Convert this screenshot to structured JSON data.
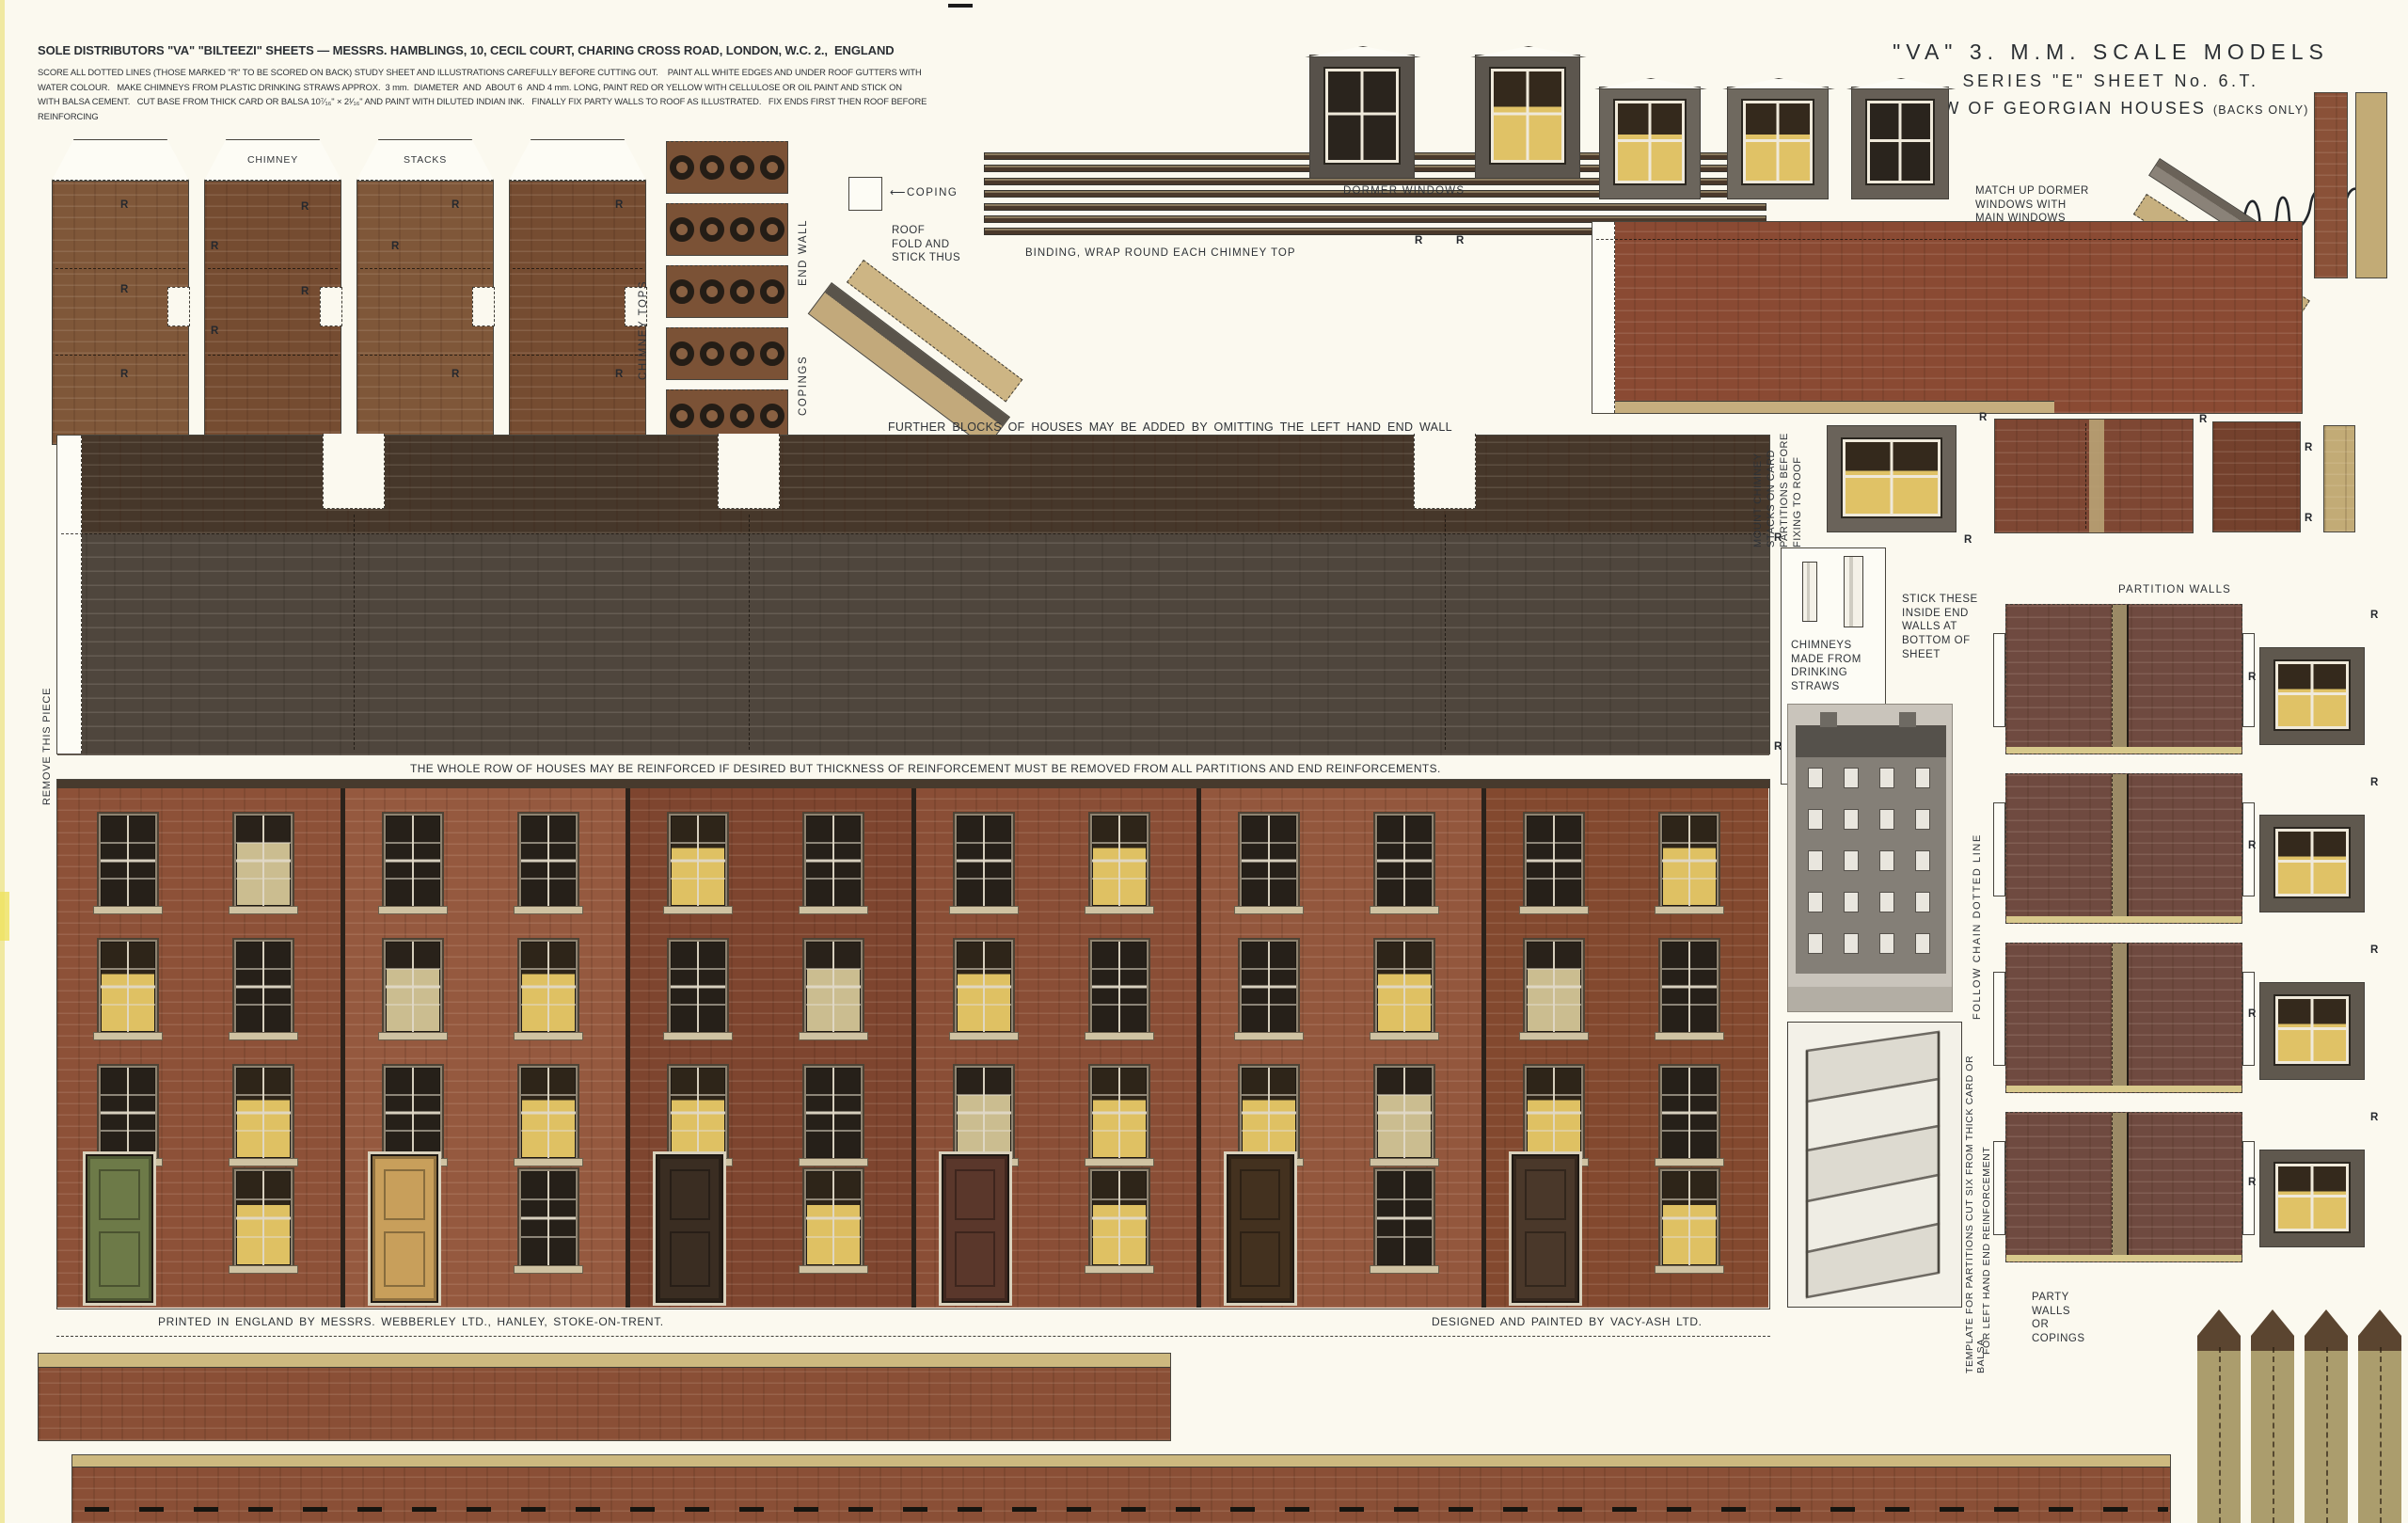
{
  "colors": {
    "paper": "#fbf9ef",
    "ink": "#2e3237",
    "brick_wall": "#8d5138",
    "roof_band": "#46372a",
    "roof_slate": "#4f463d",
    "stack_brown": "#7b5236",
    "partition_brick": "#6f4a40",
    "big_piece": "#8a4a33",
    "tan": "#c6ae7e",
    "olive": "#ab9d6d",
    "window_lit": "#dfc163",
    "sill": "#cfc2a2"
  },
  "header": {
    "title": "SOLE DISTRIBUTORS \"VA\" \"BILTEEZI\" SHEETS — MESSRS. HAMBLINGS, 10, CECIL COURT, CHARING CROSS ROAD, LONDON, W.C. 2.,  ENGLAND",
    "instructions": [
      "SCORE ALL DOTTED LINES (THOSE MARKED \"R\" TO BE SCORED ON BACK) STUDY SHEET AND ILLUSTRATIONS CAREFULLY BEFORE CUTTING OUT.    PAINT ALL WHITE EDGES AND UNDER ROOF GUTTERS WITH",
      "WATER COLOUR.   MAKE CHIMNEYS FROM PLASTIC DRINKING STRAWS APPROX.  3 mm.  DIAMETER  AND  ABOUT 6  AND 4 mm. LONG, PAINT RED OR YELLOW WITH CELLULOSE OR OIL PAINT AND STICK ON",
      "WITH BALSA CEMENT.   CUT BASE FROM THICK CARD OR BALSA 10⁷⁄₁₆\" × 2¹⁄₁₆\" AND PAINT WITH DILUTED INDIAN INK.   FINALLY FIX PARTY WALLS TO ROOF AS ILLUSTRATED.   FIX ENDS FIRST THEN ROOF BEFORE",
      "REINFORCING"
    ]
  },
  "masthead": {
    "line1": "\"VA\" 3. M.M. SCALE MODELS",
    "line2": "SERIES \"E\" SHEET No. 6.T.",
    "line3": "ROW OF GEORGIAN HOUSES",
    "line3_small": "(BACKS ONLY)"
  },
  "labels": {
    "chimney": "CHIMNEY",
    "stacks": "STACKS",
    "chimney_tops": "CHIMNEY  TOPS",
    "end_wall": "END  WALL",
    "coping": "⟵COPING",
    "roof_fold": "ROOF\nFOLD  AND\nSTICK THUS",
    "copings": "COPINGS",
    "binding": "BINDING, WRAP ROUND EACH CHIMNEY TOP",
    "dormer_windows": "DORMER  WINDOWS",
    "match_up": "MATCH UP DORMER\nWINDOWS WITH\nMAIN WINDOWS",
    "further_1": "FURTHER  BLOCKS  OF  HOUSES  MAY  BE  ADDED  BY  OMITTING  THE  LEFT  HAND  END  WALL",
    "further_2a": "AND YARD WALL.   JOIN BLOCK AND ROOF UP TO RIGHT END WALL BUT DO ",
    "further_2b": "NOT",
    "further_2c": " REMOVE SMALL PIECE FROM LEFT CORNER  OF  ROOF",
    "whole_row": "THE  WHOLE  ROW  OF  HOUSES  MAY  BE  REINFORCED  IF  DESIRED  BUT  THICKNESS  OF  REINFORCEMENT  MUST  BE  REMOVED  FROM  ALL  PARTITIONS  AND  END  REINFORCEMENTS.",
    "remove_piece": "REMOVE THIS\nPIECE",
    "mount_chimney": "MOUNT CHIMNEY STACKS ON CARD PARTITIONS BEFORE FIXING TO ROOF",
    "chimneys_straws": "CHIMNEYS\nMADE FROM\nDRINKING\nSTRAWS",
    "stick_these": "STICK THESE\nINSIDE END\nWALLS AT\nBOTTOM OF\nSHEET",
    "follow_chain": "FOLLOW CHAIN DOTTED LINE",
    "template_1": "TEMPLATE FOR PARTITIONS CUT SIX FROM THICK CARD OR BALSA",
    "template_2": "FOR LEFT HAND END REINFORCEMENT",
    "partition_walls": "PARTITION  WALLS",
    "party_walls": "PARTY\nWALLS\nOR\nCOPINGS",
    "r_mark": "R"
  },
  "captions": {
    "printer": "PRINTED  IN  ENGLAND  BY  MESSRS.  WEBBERLEY  LTD.,  HANLEY,  STOKE-ON-TRENT.",
    "designer": "DESIGNED AND PAINTED BY VACY-ASH LTD."
  },
  "houses": {
    "units": [
      {
        "shade": "#8d5138",
        "door": "#6d7a48",
        "w": [
          [
            0,
            2
          ],
          [
            1,
            0
          ],
          [
            0,
            1
          ]
        ],
        "g": 1
      },
      {
        "shade": "#95593f",
        "door": "#c89f5b",
        "w": [
          [
            0,
            0
          ],
          [
            2,
            1
          ],
          [
            0,
            1
          ]
        ],
        "g": 0
      },
      {
        "shade": "#7e452f",
        "door": "#3a2d22",
        "w": [
          [
            1,
            0
          ],
          [
            0,
            2
          ],
          [
            1,
            0
          ]
        ],
        "g": 1
      },
      {
        "shade": "#8a4e36",
        "door": "#5a372b",
        "w": [
          [
            0,
            1
          ],
          [
            1,
            0
          ],
          [
            2,
            1
          ]
        ],
        "g": 1
      },
      {
        "shade": "#93573d",
        "door": "#43311f",
        "w": [
          [
            0,
            0
          ],
          [
            0,
            1
          ],
          [
            1,
            2
          ]
        ],
        "g": 0
      },
      {
        "shade": "#83492f",
        "door": "#4a382a",
        "w": [
          [
            0,
            1
          ],
          [
            2,
            0
          ],
          [
            1,
            0
          ]
        ],
        "g": 1
      }
    ]
  },
  "pieces": {
    "stack_flap_labels": [
      "",
      "CHIMNEY",
      "STACKS",
      ""
    ],
    "binding_strips": 7,
    "chimney_top_strips": 5,
    "rings_per_strip": 4,
    "partition_blocks": 4,
    "party_strips": 4,
    "top_dormers": 5,
    "side_dormers": 4
  }
}
